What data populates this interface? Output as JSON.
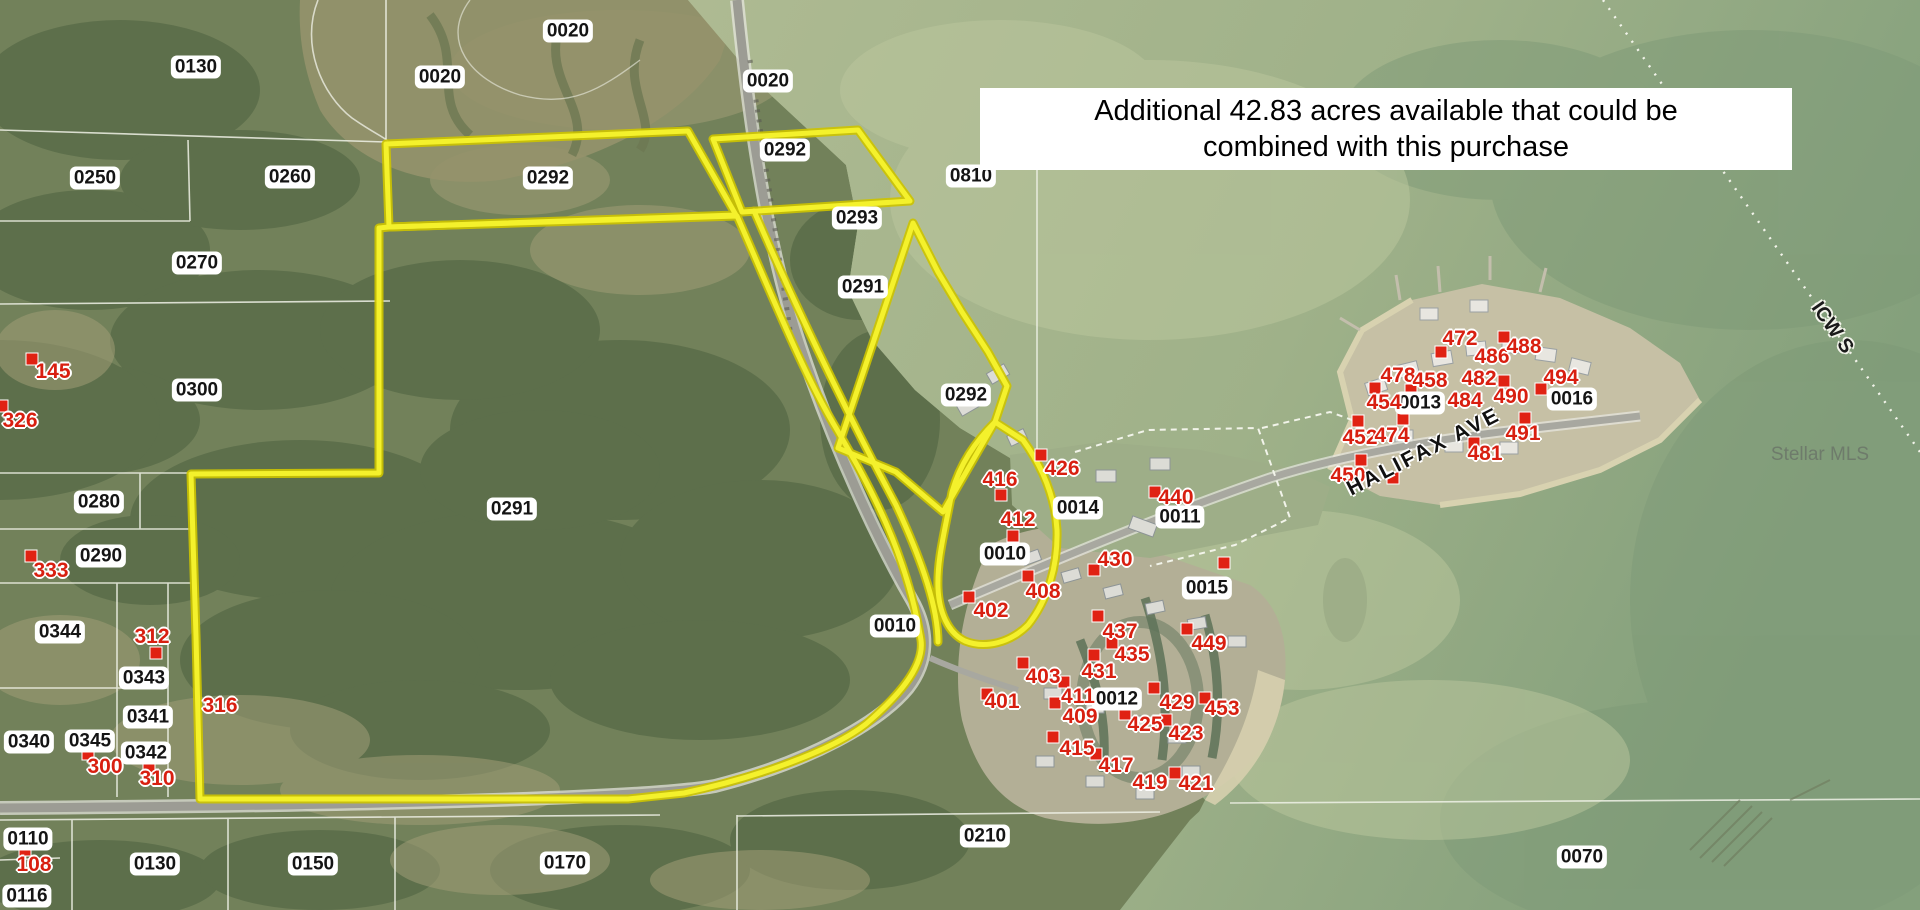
{
  "banner": {
    "line1": "Additional 42.83 acres available that could be",
    "line2": "combined with this purchase"
  },
  "map": {
    "street_label": "HALIFAX AVE",
    "waterway_label": "ICW S",
    "watermark": "Stellar MLS"
  },
  "colors": {
    "boundary_yellow": "#f1ee26",
    "marker_red": "#e02213",
    "address_red": "#d81f10",
    "water": "#a9b890",
    "land": "#72815a",
    "label_bg": "#ffffff",
    "label_text": "#141414"
  },
  "parcel_labels": [
    {
      "text": "0130",
      "x": 196,
      "y": 67
    },
    {
      "text": "0020",
      "x": 440,
      "y": 77
    },
    {
      "text": "0020",
      "x": 568,
      "y": 31
    },
    {
      "text": "0020",
      "x": 768,
      "y": 81
    },
    {
      "text": "0250",
      "x": 95,
      "y": 178
    },
    {
      "text": "0260",
      "x": 290,
      "y": 177
    },
    {
      "text": "0270",
      "x": 197,
      "y": 263
    },
    {
      "text": "0300",
      "x": 197,
      "y": 390
    },
    {
      "text": "0292",
      "x": 548,
      "y": 178
    },
    {
      "text": "0292",
      "x": 785,
      "y": 150
    },
    {
      "text": "0293",
      "x": 857,
      "y": 218
    },
    {
      "text": "0291",
      "x": 863,
      "y": 287
    },
    {
      "text": "0292",
      "x": 966,
      "y": 395
    },
    {
      "text": "0810",
      "x": 971,
      "y": 176
    },
    {
      "text": "0291",
      "x": 512,
      "y": 509
    },
    {
      "text": "0280",
      "x": 99,
      "y": 502
    },
    {
      "text": "0290",
      "x": 101,
      "y": 556
    },
    {
      "text": "0344",
      "x": 60,
      "y": 632
    },
    {
      "text": "0343",
      "x": 144,
      "y": 678
    },
    {
      "text": "0341",
      "x": 148,
      "y": 717
    },
    {
      "text": "0345",
      "x": 90,
      "y": 741
    },
    {
      "text": "0340",
      "x": 29,
      "y": 742
    },
    {
      "text": "0342",
      "x": 146,
      "y": 753
    },
    {
      "text": "0110",
      "x": 28,
      "y": 839
    },
    {
      "text": "0116",
      "x": 27,
      "y": 896
    },
    {
      "text": "0130",
      "x": 155,
      "y": 864
    },
    {
      "text": "0150",
      "x": 313,
      "y": 864
    },
    {
      "text": "0170",
      "x": 565,
      "y": 863
    },
    {
      "text": "0010",
      "x": 1005,
      "y": 554
    },
    {
      "text": "0010",
      "x": 895,
      "y": 626
    },
    {
      "text": "0014",
      "x": 1078,
      "y": 508
    },
    {
      "text": "0011",
      "x": 1180,
      "y": 517
    },
    {
      "text": "0015",
      "x": 1207,
      "y": 588
    },
    {
      "text": "0013",
      "x": 1420,
      "y": 403
    },
    {
      "text": "0016",
      "x": 1572,
      "y": 399
    },
    {
      "text": "0012",
      "x": 1117,
      "y": 699
    },
    {
      "text": "0210",
      "x": 985,
      "y": 836
    },
    {
      "text": "0070",
      "x": 1582,
      "y": 857
    }
  ],
  "address_labels": [
    {
      "text": "145",
      "x": 53,
      "y": 372
    },
    {
      "text": "326",
      "x": 20,
      "y": 421
    },
    {
      "text": "333",
      "x": 51,
      "y": 571
    },
    {
      "text": "312",
      "x": 152,
      "y": 637
    },
    {
      "text": "316",
      "x": 220,
      "y": 706
    },
    {
      "text": "300",
      "x": 105,
      "y": 767
    },
    {
      "text": "310",
      "x": 157,
      "y": 779
    },
    {
      "text": "108",
      "x": 34,
      "y": 865
    },
    {
      "text": "402",
      "x": 991,
      "y": 611
    },
    {
      "text": "401",
      "x": 1002,
      "y": 702
    },
    {
      "text": "403",
      "x": 1043,
      "y": 677
    },
    {
      "text": "411",
      "x": 1078,
      "y": 697
    },
    {
      "text": "409",
      "x": 1080,
      "y": 717
    },
    {
      "text": "415",
      "x": 1077,
      "y": 749
    },
    {
      "text": "417",
      "x": 1116,
      "y": 766
    },
    {
      "text": "419",
      "x": 1150,
      "y": 783
    },
    {
      "text": "421",
      "x": 1196,
      "y": 784
    },
    {
      "text": "423",
      "x": 1186,
      "y": 734
    },
    {
      "text": "425",
      "x": 1145,
      "y": 725
    },
    {
      "text": "429",
      "x": 1177,
      "y": 703
    },
    {
      "text": "453",
      "x": 1222,
      "y": 709
    },
    {
      "text": "431",
      "x": 1099,
      "y": 672
    },
    {
      "text": "435",
      "x": 1132,
      "y": 655
    },
    {
      "text": "437",
      "x": 1120,
      "y": 632
    },
    {
      "text": "449",
      "x": 1209,
      "y": 644
    },
    {
      "text": "430",
      "x": 1115,
      "y": 560
    },
    {
      "text": "408",
      "x": 1043,
      "y": 592
    },
    {
      "text": "412",
      "x": 1018,
      "y": 520
    },
    {
      "text": "416",
      "x": 1000,
      "y": 480
    },
    {
      "text": "426",
      "x": 1062,
      "y": 469
    },
    {
      "text": "440",
      "x": 1176,
      "y": 498
    },
    {
      "text": "450",
      "x": 1348,
      "y": 476
    },
    {
      "text": "452",
      "x": 1360,
      "y": 438
    },
    {
      "text": "474",
      "x": 1392,
      "y": 436
    },
    {
      "text": "454",
      "x": 1384,
      "y": 403
    },
    {
      "text": "478",
      "x": 1398,
      "y": 376
    },
    {
      "text": "458",
      "x": 1430,
      "y": 381
    },
    {
      "text": "472",
      "x": 1460,
      "y": 339
    },
    {
      "text": "486",
      "x": 1492,
      "y": 357
    },
    {
      "text": "488",
      "x": 1524,
      "y": 347
    },
    {
      "text": "482",
      "x": 1479,
      "y": 379
    },
    {
      "text": "484",
      "x": 1465,
      "y": 401
    },
    {
      "text": "490",
      "x": 1511,
      "y": 397
    },
    {
      "text": "494",
      "x": 1561,
      "y": 378
    },
    {
      "text": "491",
      "x": 1523,
      "y": 434
    },
    {
      "text": "481",
      "x": 1485,
      "y": 454
    }
  ],
  "markers": [
    {
      "x": 32,
      "y": 359
    },
    {
      "x": 2,
      "y": 406
    },
    {
      "x": 31,
      "y": 556
    },
    {
      "x": 156,
      "y": 653
    },
    {
      "x": 88,
      "y": 754
    },
    {
      "x": 149,
      "y": 767
    },
    {
      "x": 25,
      "y": 850
    },
    {
      "x": 969,
      "y": 597
    },
    {
      "x": 987,
      "y": 694
    },
    {
      "x": 1023,
      "y": 663
    },
    {
      "x": 1055,
      "y": 703
    },
    {
      "x": 1064,
      "y": 682
    },
    {
      "x": 1053,
      "y": 737
    },
    {
      "x": 1096,
      "y": 754
    },
    {
      "x": 1175,
      "y": 773
    },
    {
      "x": 1166,
      "y": 720
    },
    {
      "x": 1125,
      "y": 714
    },
    {
      "x": 1154,
      "y": 688
    },
    {
      "x": 1205,
      "y": 698
    },
    {
      "x": 1094,
      "y": 655
    },
    {
      "x": 1112,
      "y": 643
    },
    {
      "x": 1098,
      "y": 616
    },
    {
      "x": 1187,
      "y": 629
    },
    {
      "x": 1094,
      "y": 570
    },
    {
      "x": 1028,
      "y": 576
    },
    {
      "x": 1013,
      "y": 536
    },
    {
      "x": 1001,
      "y": 495
    },
    {
      "x": 1041,
      "y": 455
    },
    {
      "x": 1155,
      "y": 492
    },
    {
      "x": 1224,
      "y": 563
    },
    {
      "x": 1361,
      "y": 460
    },
    {
      "x": 1358,
      "y": 421
    },
    {
      "x": 1403,
      "y": 419
    },
    {
      "x": 1375,
      "y": 388
    },
    {
      "x": 1411,
      "y": 390
    },
    {
      "x": 1441,
      "y": 352
    },
    {
      "x": 1504,
      "y": 337
    },
    {
      "x": 1504,
      "y": 381
    },
    {
      "x": 1541,
      "y": 389
    },
    {
      "x": 1525,
      "y": 418
    },
    {
      "x": 1474,
      "y": 443
    },
    {
      "x": 1393,
      "y": 478
    }
  ]
}
